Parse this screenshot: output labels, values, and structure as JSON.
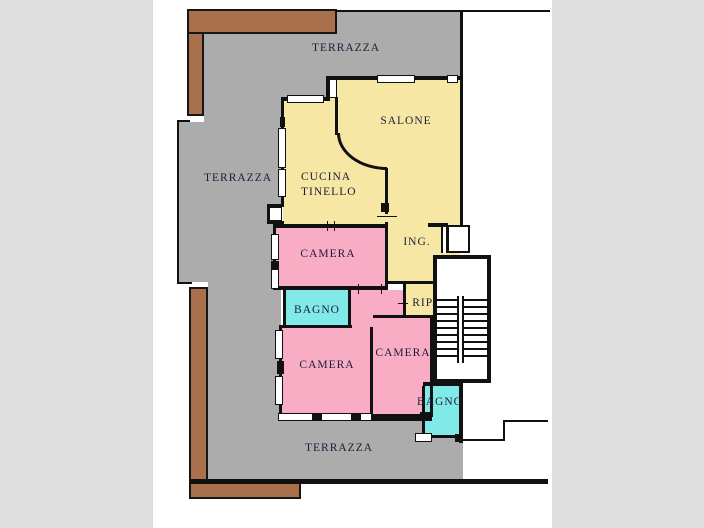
{
  "type": "floor-plan",
  "palette": {
    "background": "#dedede",
    "paper": "#ffffff",
    "terrace": "#acacac",
    "balcony": "#a8714b",
    "living": "#f7e7a5",
    "bedroom": "#f9adc5",
    "bath": "#82e9e9",
    "wall": "#111111",
    "text": "#1c1c38"
  },
  "labels": {
    "terrazza_top": "TERRAZZA",
    "terrazza_left": "TERRAZZA",
    "terrazza_bottom": "TERRAZZA",
    "salone": "SALONE",
    "cucina_line1": "CUCINA",
    "cucina_line2": "TINELLO",
    "camera_top": "CAMERA",
    "camera_left": "CAMERA",
    "camera_right": "CAMERA",
    "bagno_left": "BAGNO",
    "bagno_right": "BAGNO",
    "ingresso": "ING.",
    "ripostiglio": "RIP."
  }
}
